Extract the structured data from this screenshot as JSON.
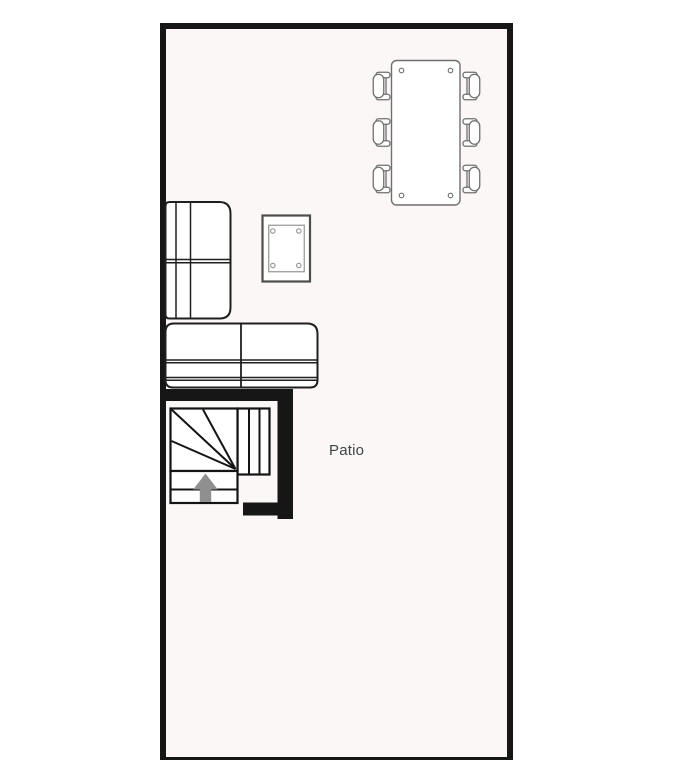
{
  "room": {
    "label": "Patio"
  },
  "colors": {
    "wall": "#161616",
    "room-fill": "#fbf7f7",
    "furniture-fill": "#ffffff",
    "sofa-line": "#1f1f1f",
    "chair-line": "#6f6f6f",
    "stair-line": "#141414",
    "side-table-line": "#4d4d4d",
    "side-table-inner-line": "#949494",
    "arrow-fill": "#8f8f8f",
    "label-text": "#3e4347"
  },
  "furniture": [
    {
      "name": "dining-table",
      "seats": 6
    },
    {
      "name": "two-seat-sofa-left-wall"
    },
    {
      "name": "two-seat-sofa-bottom"
    },
    {
      "name": "side-table"
    },
    {
      "name": "winder-staircase",
      "direction": "up"
    }
  ]
}
